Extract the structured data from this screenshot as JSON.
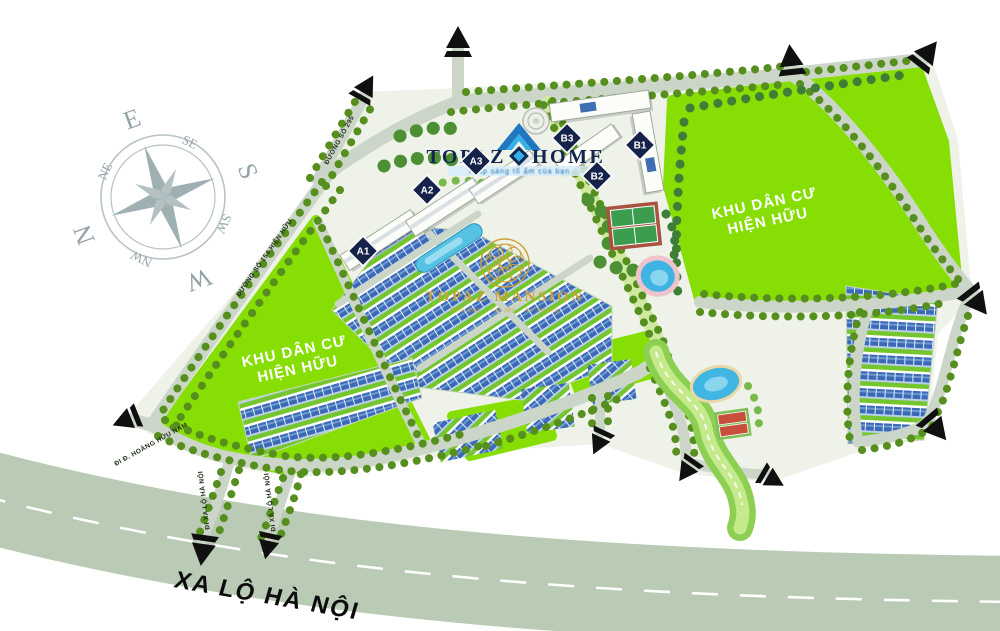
{
  "compass": {
    "e": "E",
    "se": "SE",
    "s": "S",
    "sw": "SW",
    "w": "W",
    "nw": "NW",
    "n": "N",
    "ne": "NE"
  },
  "logo": {
    "brand_left": "TOPAZ",
    "brand_right": "HOME",
    "tagline": "Thắp sáng tổ ấm của bạn"
  },
  "mansion": {
    "title": "TOPAZ MANSION",
    "tagline": "Phú quý · Tài lộc · An khang"
  },
  "area_labels": {
    "left": {
      "line1": "KHU DÂN CƯ",
      "line2": "HIỆN HỮU"
    },
    "right": {
      "line1": "KHU DÂN CƯ",
      "line2": "HIỆN HỮU"
    }
  },
  "roads": {
    "highway": "XA LỘ HÀ NỘI",
    "road_295": "ĐƯỜNG SỐ 295",
    "road_154": "ĐƯỜNG SỐ 154 HIỆN HỮU",
    "to_hoang_huu_nam": "ĐI Đ. HOÀNG HỮU NAM",
    "to_xa_lo_ha_noi_1": "ĐI XA LỘ HÀ NỘI",
    "to_xa_lo_ha_noi_2": "ĐI XA LỘ HÀ NỘI"
  },
  "blocks": {
    "a1": "A1",
    "a2": "A2",
    "a3": "A3",
    "b1": "B1",
    "b2": "B2",
    "b3": "B3"
  },
  "colors": {
    "field_green": "#87DE04",
    "road": "#CCD6C8",
    "highway": "#B9CAB5",
    "tree": "#568F1E",
    "navy": "#15234A",
    "logo_blue": "#2AA4E4",
    "gold": "#C9A132",
    "villa_blue": "#3A69B8",
    "pool_blue": "#41B6E3",
    "arrow_black": "#111111"
  }
}
